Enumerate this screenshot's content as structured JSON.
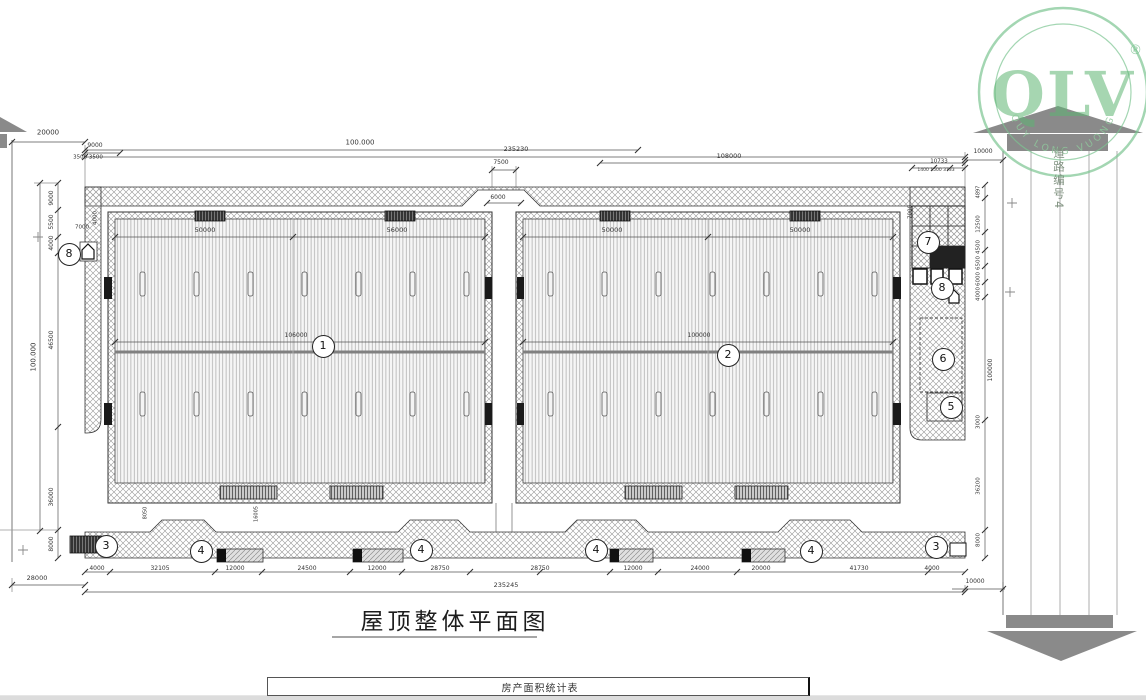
{
  "logo": {
    "text": "QLV",
    "reg": "®",
    "arc_text": "QUY LONG VUONG",
    "color": "#6ab97e"
  },
  "road": {
    "label": "道路编号4"
  },
  "title": {
    "text": "屋顶整体平面图"
  },
  "table": {
    "header": "房产面积统计表"
  },
  "annotations": {
    "markers": [
      {
        "n": "8",
        "x": 68,
        "y": 253
      },
      {
        "n": "1",
        "x": 322,
        "y": 345
      },
      {
        "n": "2",
        "x": 727,
        "y": 354
      },
      {
        "n": "7",
        "x": 927,
        "y": 241
      },
      {
        "n": "8",
        "x": 941,
        "y": 287
      },
      {
        "n": "6",
        "x": 942,
        "y": 358
      },
      {
        "n": "5",
        "x": 950,
        "y": 406
      },
      {
        "n": "3",
        "x": 105,
        "y": 545
      },
      {
        "n": "4",
        "x": 200,
        "y": 550
      },
      {
        "n": "4",
        "x": 420,
        "y": 549
      },
      {
        "n": "4",
        "x": 595,
        "y": 549
      },
      {
        "n": "4",
        "x": 810,
        "y": 550
      },
      {
        "n": "3",
        "x": 935,
        "y": 546
      }
    ],
    "dims": [
      {
        "t": "20000",
        "x": 48,
        "y": 133
      },
      {
        "t": "9000",
        "x": 95,
        "y": 146,
        "s": 6
      },
      {
        "t": "3500 3500",
        "x": 88,
        "y": 158,
        "s": 5.5
      },
      {
        "t": "100.000",
        "x": 360,
        "y": 143,
        "s": 7
      },
      {
        "t": "235230",
        "x": 516,
        "y": 149,
        "s": 6.5
      },
      {
        "t": "7500",
        "x": 501,
        "y": 163,
        "s": 6
      },
      {
        "t": "108000",
        "x": 729,
        "y": 156,
        "s": 6.5
      },
      {
        "t": "10733",
        "x": 939,
        "y": 162,
        "s": 5.5
      },
      {
        "t": "1400 1500 3733",
        "x": 936,
        "y": 171,
        "s": 4.5
      },
      {
        "t": "10000",
        "x": 983,
        "y": 152,
        "s": 6
      },
      {
        "t": "6000",
        "x": 498,
        "y": 198,
        "s": 6
      },
      {
        "t": "50000",
        "x": 205,
        "y": 230,
        "s": 6.5
      },
      {
        "t": "56000",
        "x": 397,
        "y": 230,
        "s": 6.5
      },
      {
        "t": "50000",
        "x": 612,
        "y": 230,
        "s": 6.5
      },
      {
        "t": "50000",
        "x": 800,
        "y": 230,
        "s": 6.5
      },
      {
        "t": "106000",
        "x": 296,
        "y": 336,
        "s": 6
      },
      {
        "t": "100000",
        "x": 699,
        "y": 336,
        "s": 6
      },
      {
        "t": "9000",
        "x": 52,
        "y": 198,
        "r": 1,
        "s": 6
      },
      {
        "t": "5500",
        "x": 52,
        "y": 222,
        "r": 1,
        "s": 6
      },
      {
        "t": "4000",
        "x": 52,
        "y": 243,
        "r": 1,
        "s": 6
      },
      {
        "t": "46500",
        "x": 52,
        "y": 340,
        "r": 1,
        "s": 6
      },
      {
        "t": "36000",
        "x": 52,
        "y": 497,
        "r": 1,
        "s": 6
      },
      {
        "t": "8000",
        "x": 52,
        "y": 544,
        "r": 1,
        "s": 6
      },
      {
        "t": "100.000",
        "x": 34,
        "y": 357,
        "r": 1,
        "s": 7
      },
      {
        "t": "7000",
        "x": 82,
        "y": 228,
        "s": 5.5
      },
      {
        "t": "4000",
        "x": 96,
        "y": 218,
        "r": 1,
        "s": 5.5
      },
      {
        "t": "7000",
        "x": 911,
        "y": 212,
        "r": 1,
        "s": 5.5
      },
      {
        "t": "4897",
        "x": 979,
        "y": 192,
        "r": 1,
        "s": 5
      },
      {
        "t": "12500",
        "x": 979,
        "y": 224,
        "r": 1,
        "s": 5.5
      },
      {
        "t": "4500",
        "x": 979,
        "y": 247,
        "r": 1,
        "s": 5.5
      },
      {
        "t": "6500",
        "x": 979,
        "y": 263,
        "r": 1,
        "s": 5.5
      },
      {
        "t": "6000",
        "x": 979,
        "y": 279,
        "r": 1,
        "s": 5.5
      },
      {
        "t": "4000",
        "x": 979,
        "y": 294,
        "r": 1,
        "s": 5.5
      },
      {
        "t": "100000",
        "x": 991,
        "y": 370,
        "r": 1,
        "s": 6
      },
      {
        "t": "3000",
        "x": 979,
        "y": 422,
        "r": 1,
        "s": 5.5
      },
      {
        "t": "36200",
        "x": 979,
        "y": 486,
        "r": 1,
        "s": 5.5
      },
      {
        "t": "8000",
        "x": 979,
        "y": 540,
        "r": 1,
        "s": 5.5
      },
      {
        "t": "8050",
        "x": 146,
        "y": 513,
        "r": 1,
        "s": 5
      },
      {
        "t": "16005",
        "x": 257,
        "y": 514,
        "r": 1,
        "s": 5
      },
      {
        "t": "4000",
        "x": 97,
        "y": 569,
        "s": 6
      },
      {
        "t": "32105",
        "x": 160,
        "y": 569,
        "s": 6
      },
      {
        "t": "12000",
        "x": 235,
        "y": 569,
        "s": 6
      },
      {
        "t": "24500",
        "x": 307,
        "y": 569,
        "s": 6
      },
      {
        "t": "12000",
        "x": 377,
        "y": 569,
        "s": 6
      },
      {
        "t": "28750",
        "x": 440,
        "y": 569,
        "s": 6
      },
      {
        "t": "28750",
        "x": 540,
        "y": 569,
        "s": 6
      },
      {
        "t": "12000",
        "x": 633,
        "y": 569,
        "s": 6
      },
      {
        "t": "24000",
        "x": 700,
        "y": 569,
        "s": 6
      },
      {
        "t": "20000",
        "x": 761,
        "y": 569,
        "s": 6
      },
      {
        "t": "41730",
        "x": 859,
        "y": 569,
        "s": 6
      },
      {
        "t": "4000",
        "x": 932,
        "y": 569,
        "s": 6
      },
      {
        "t": "28000",
        "x": 37,
        "y": 578,
        "s": 6.5
      },
      {
        "t": "235245",
        "x": 506,
        "y": 585,
        "s": 6.5
      },
      {
        "t": "10000",
        "x": 975,
        "y": 582,
        "s": 6
      }
    ]
  }
}
